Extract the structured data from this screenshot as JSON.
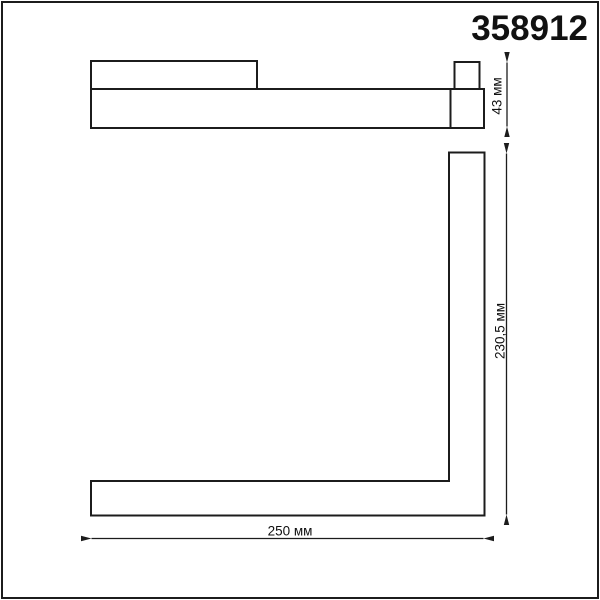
{
  "product": {
    "code": "358912"
  },
  "dimensions": {
    "height_label": "43 мм",
    "side_label": "230,5 мм",
    "width_label": "250 мм"
  },
  "colors": {
    "line": "#1c1c1c",
    "background": "#ffffff",
    "text": "#111111"
  }
}
